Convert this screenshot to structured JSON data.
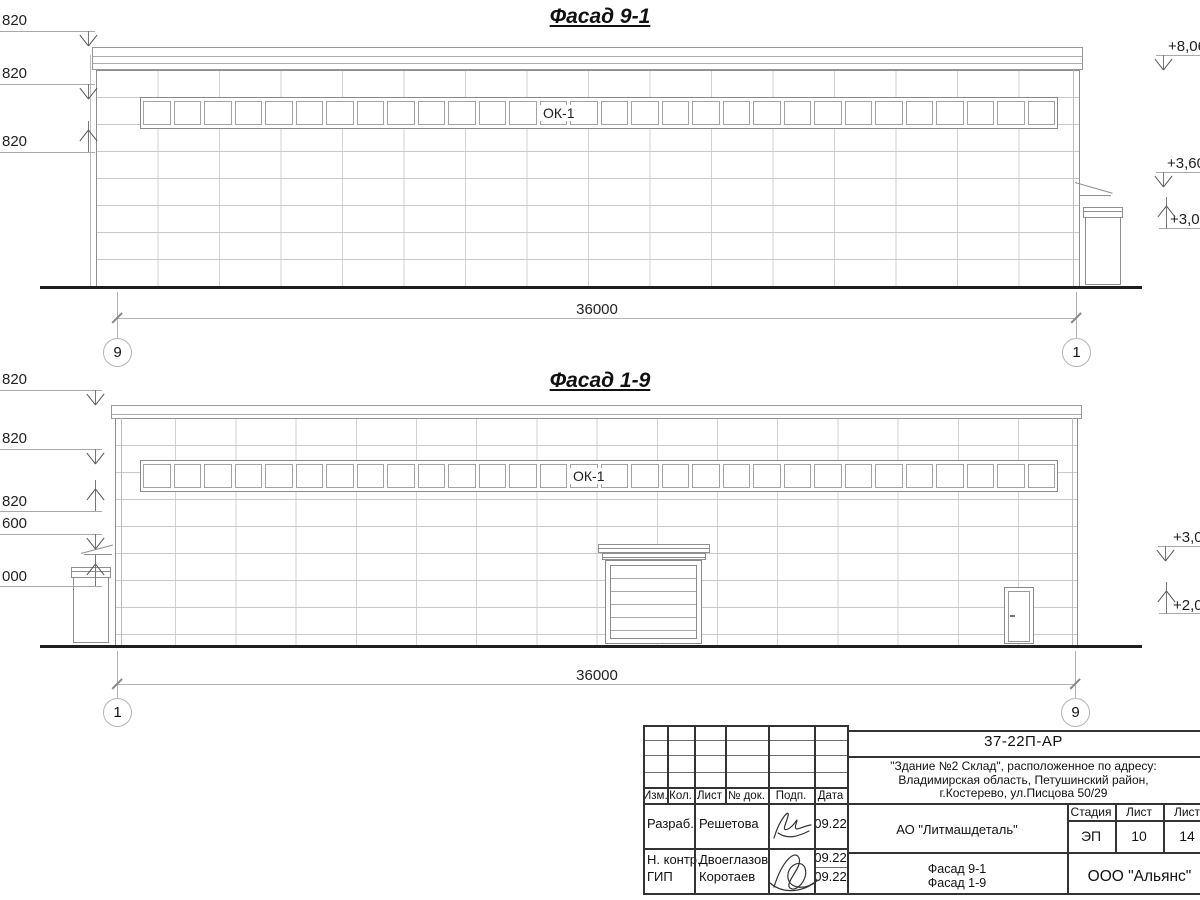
{
  "drawing": {
    "facade_top": {
      "title": "Фасад 9-1",
      "window_label": "ОК-1",
      "window_count": 30,
      "dimension": "36000",
      "axis_left": "9",
      "axis_right": "1",
      "left_marks": [
        "820",
        "820",
        "820"
      ],
      "right_marks": [
        "+8,06",
        "+3,60",
        "+3,00"
      ]
    },
    "facade_bottom": {
      "title": "Фасад 1-9",
      "window_label": "ОК-1",
      "window_count": 30,
      "dimension": "36000",
      "axis_left": "1",
      "axis_right": "9",
      "left_marks": [
        "820",
        "820",
        "820",
        "600",
        "000"
      ],
      "right_marks": [
        "+3,0",
        "+2,00"
      ]
    }
  },
  "title_block": {
    "doc_code": "37-22П-АР",
    "address_lines": [
      "\"Здание №2 Склад\", расположенное по адресу:",
      "Владимирская область, Петушинский район,",
      "г.Костерево, ул.Писцова 50/29"
    ],
    "client": "АО \"Литмашдеталь\"",
    "sheet_titles": [
      "Фасад 9-1",
      "Фасад 1-9"
    ],
    "company": "ООО \"Альянс\"",
    "stage_label": "Стадия",
    "sheet_label": "Лист",
    "total_label": "Лист",
    "stage_value": "ЭП",
    "sheet_value": "10",
    "total_value": "14",
    "columns": [
      "Изм.",
      "Кол.",
      "Лист",
      "№ док.",
      "Подп.",
      "Дата"
    ],
    "signature_rows": [
      {
        "role": "Разраб.",
        "name": "Решетова",
        "date": "09.22"
      },
      {
        "role": "Н. контр.",
        "name": "Двоеглазов",
        "date": "09.22"
      },
      {
        "role": "ГИП",
        "name": "Коротаев",
        "date": "09.22"
      }
    ]
  }
}
